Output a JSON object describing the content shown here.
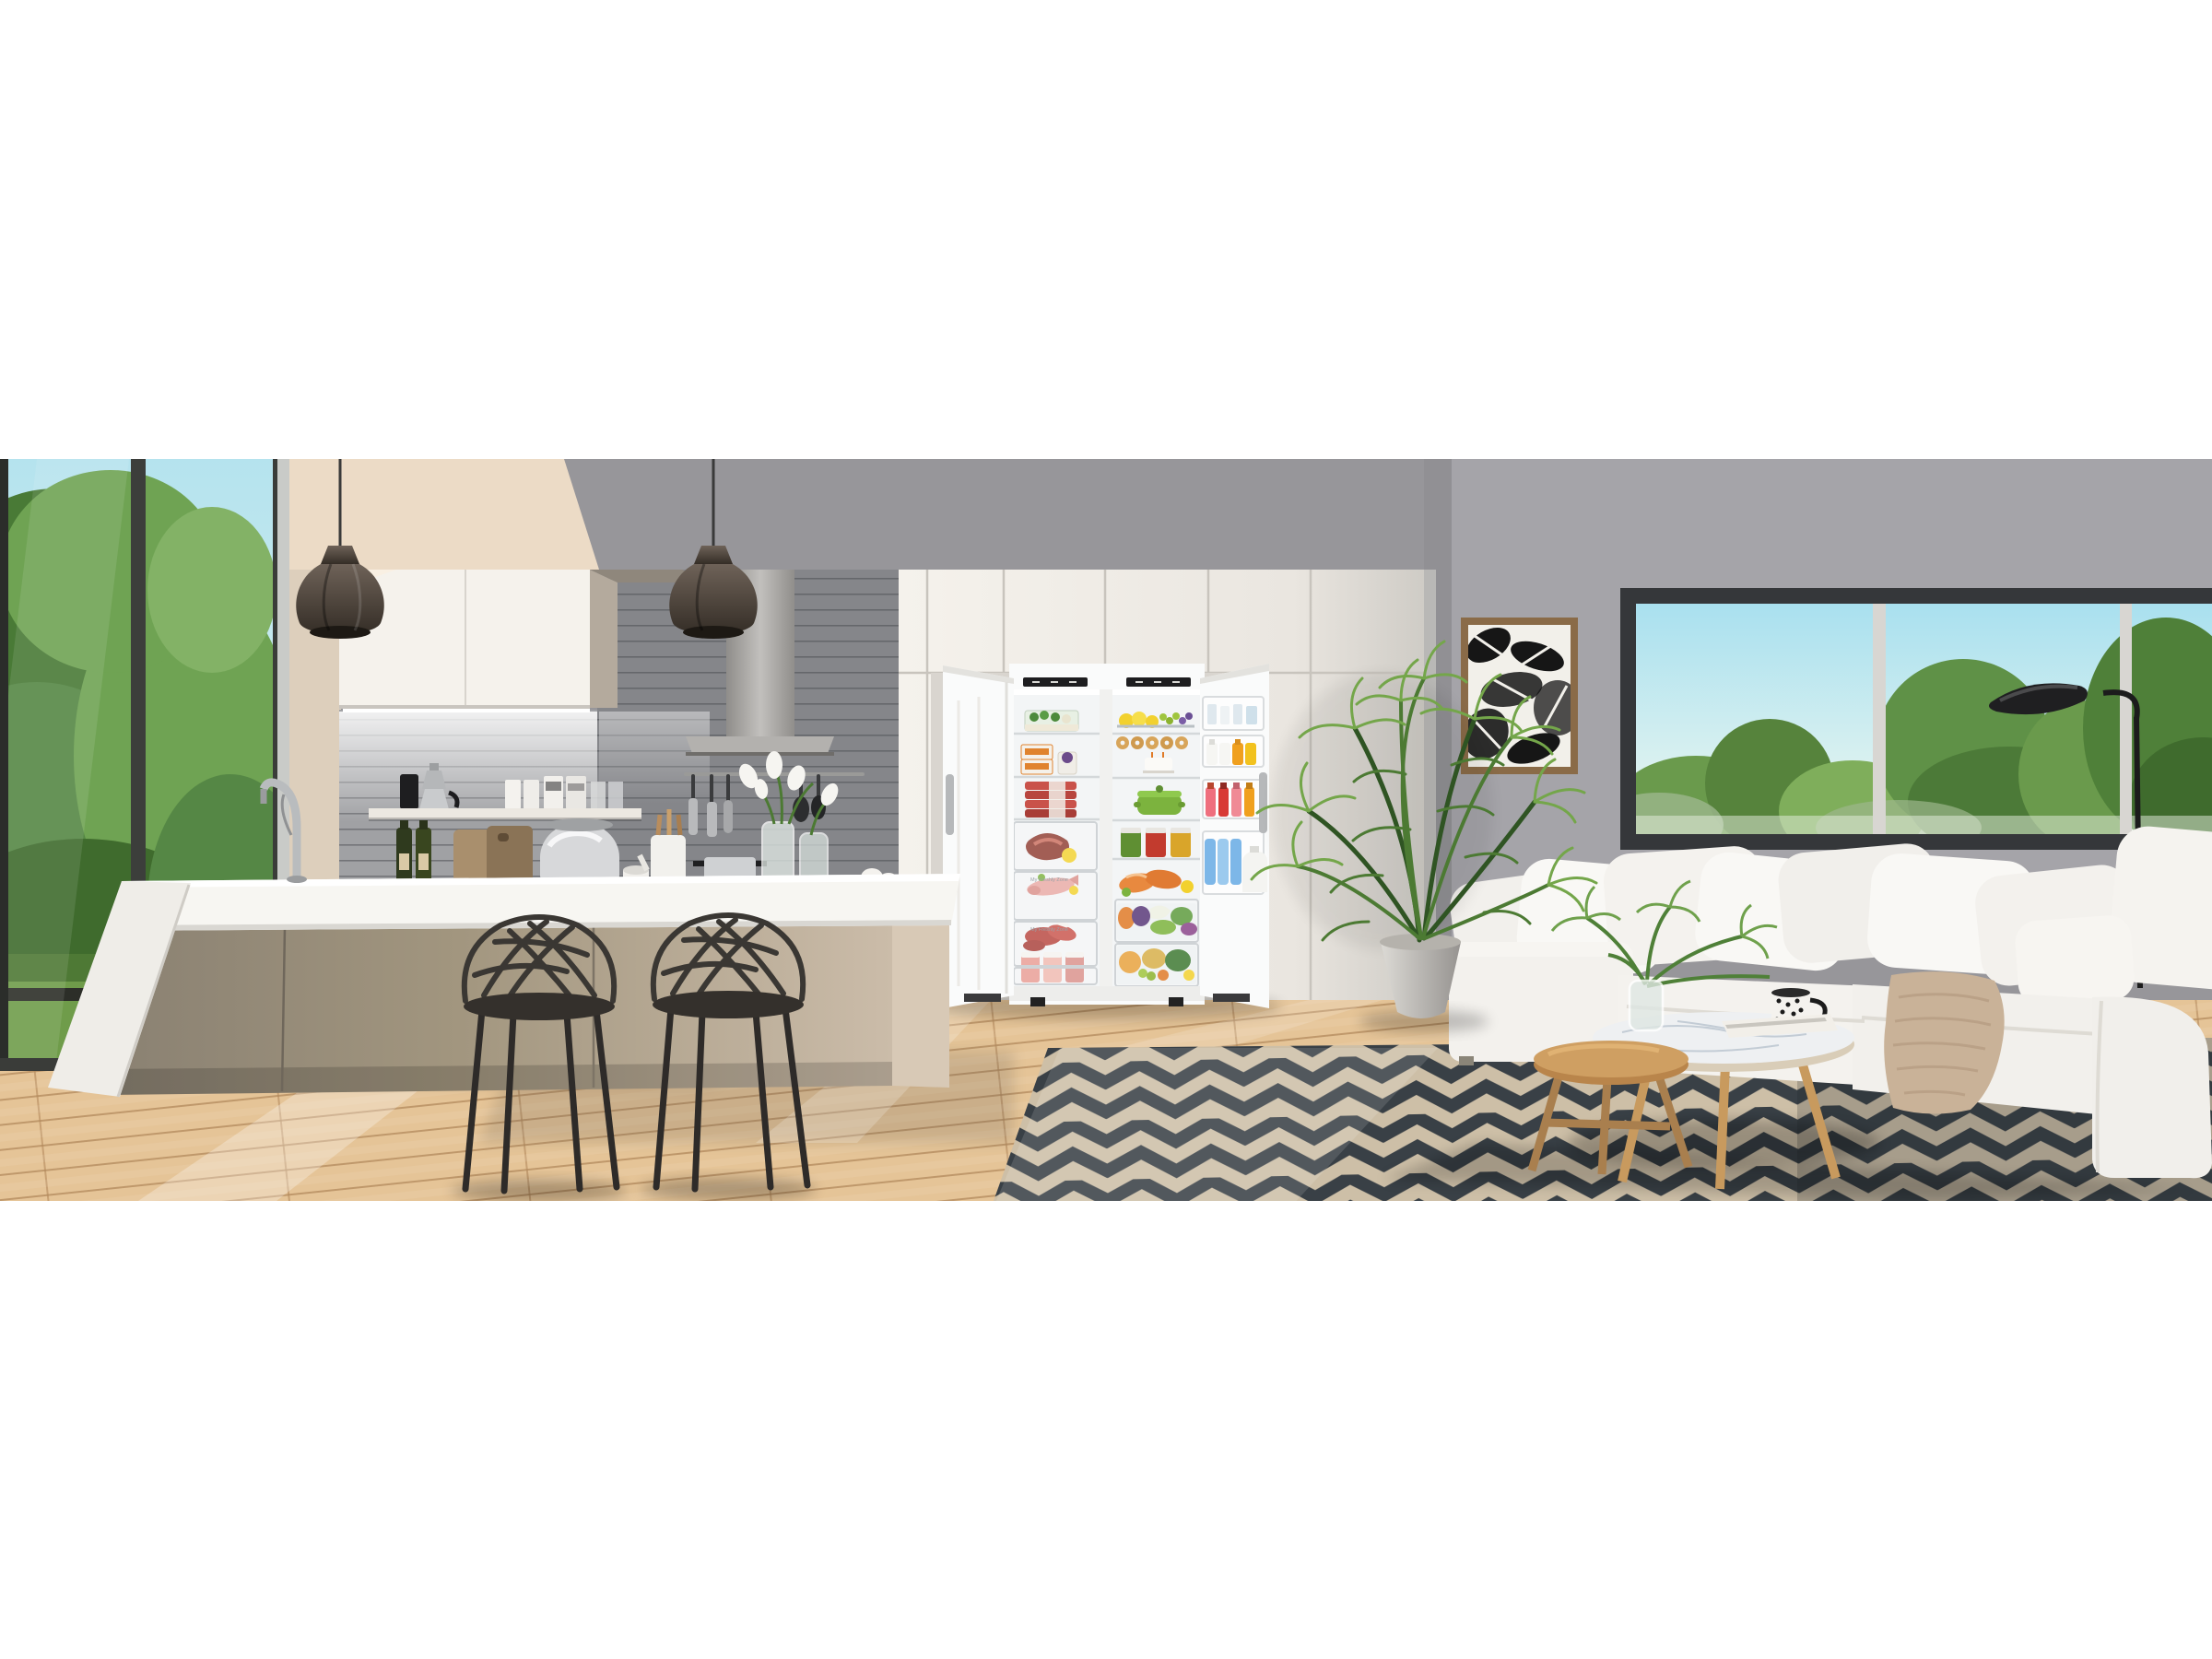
{
  "meta": {
    "title": "Open-plan kitchen and living room photograph",
    "subject": "Side-by-side upright freezer and refrigerator with both doors open, fully stocked, between white kitchen cabinetry; kitchen island with two black sculptural bar stools at left, white corner sofa with chevron rug, nesting coffee tables, areca palm, botanical art print and black floor lamp at right",
    "style": "3D architectural render, letterboxed on white"
  },
  "fridge": {
    "freezer_drawer_label_1": "My Freshly Zone",
    "freezer_drawer_label_2": "My Freshly Zone"
  },
  "palette": {
    "pageBg": "#ffffff",
    "kitchenWall": "#97969a",
    "livingWall": "#a5a4a9",
    "sunlitWall": "#ecdbc6",
    "sunlitWallSoft": "#ddcfbc",
    "cabinetWhite": "#f5f2ec",
    "cabinetShadow": "#ddd9d2",
    "cabinetSide": "#b4aa9d",
    "tileWall": "#85868a",
    "hoodSteel": "#b3b1ae",
    "pendant": "#4a4037",
    "windowFrameDark": "#35373a",
    "skyTop": "#b5e3ee",
    "skyBottom": "#e9f5ee",
    "treeGreen": "#5f9147",
    "treeGreenDark": "#42702f",
    "treeGreenLight": "#83b266",
    "lawn": "#6f9c4a",
    "counterWhite": "#f7f6f2",
    "islandTaupeDark": "#8a8172",
    "islandTaupeLight": "#cbbca9",
    "islandEnd": "#d8c9b6",
    "stool": "#34302c",
    "floorWood": "#e5c497",
    "floorSeam": "#b3895c",
    "rugBase": "#cdbfa7",
    "rugChevron": "#394046",
    "fridgeWhite": "#fafbfb",
    "fridgeInterior": "#f3f5f6",
    "displayBlack": "#1d1d1f",
    "sofaWhite": "#f3f1ed",
    "pillowWhite": "#f9f8f5",
    "throwBeige": "#c9b298",
    "artFrame": "#8a6b48",
    "plantGreen": "#4c7a33",
    "plantGreenDark": "#2f5423",
    "plantGreenLight": "#74a64a",
    "potGray": "#c9c6c0",
    "tableWood": "#cf9f62",
    "marbleTop": "#eef0f2",
    "lampBlack": "#1f1f21",
    "casseroleGreen": "#7cb33e",
    "salmonOrange": "#e8893f",
    "lemonYellow": "#f2d12e",
    "sodaPink": "#ef6f7e",
    "sodaRed": "#d83a35",
    "juiceOrange": "#f0a01e",
    "bottleBlue": "#7db7e8",
    "meatRed": "#c04a3e",
    "oliveBottle": "#2f3a1e",
    "steelBowl": "#d7d8da",
    "boardWood": "#a98f6d"
  }
}
